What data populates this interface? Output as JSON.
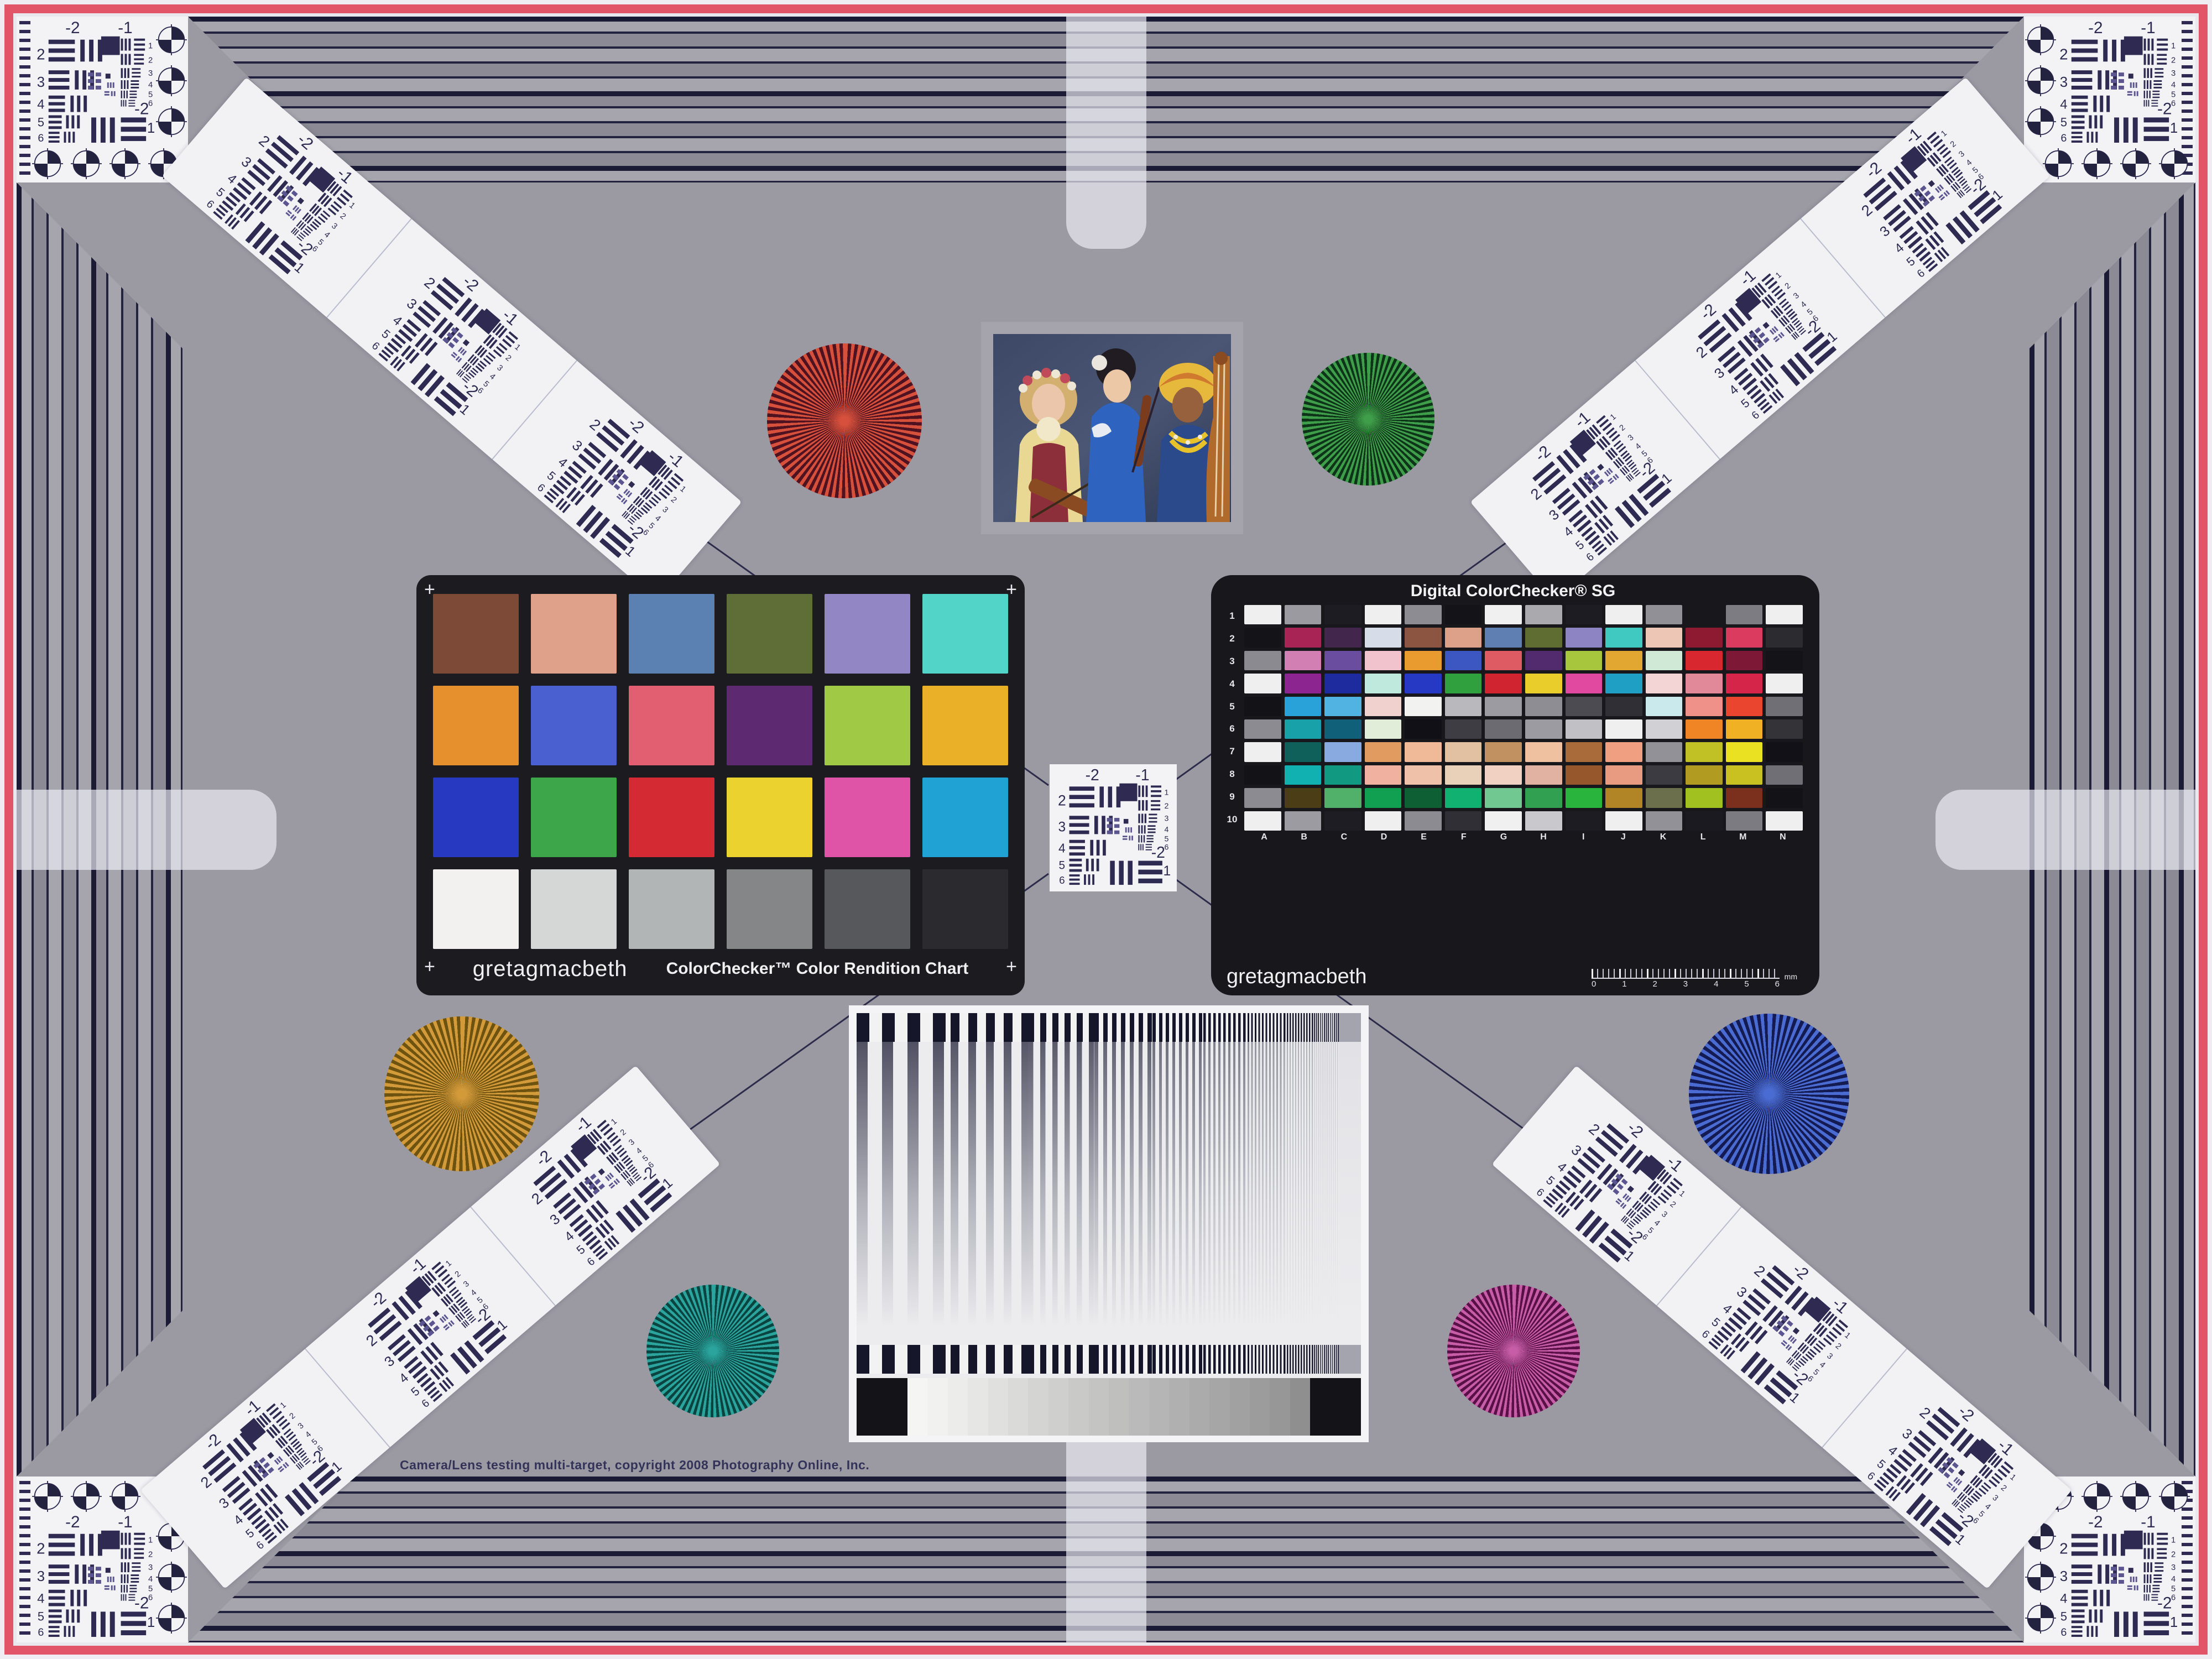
{
  "page": {
    "copyright": "Camera/Lens testing multi-target, copyright 2008 Photography Online, Inc."
  },
  "colors": {
    "background_gray": "#9b9aa3",
    "frame_pink": "#e25568",
    "line_ink": "#23233f",
    "panel_black": "#1b1b20"
  },
  "usaf": {
    "top": [
      "-2",
      "-1"
    ],
    "left": [
      "2",
      "3",
      "4",
      "5",
      "6"
    ],
    "right": [
      "1",
      "2",
      "3",
      "4",
      "5",
      "6"
    ],
    "bottom": [
      "-2",
      "1"
    ]
  },
  "colorchecker": {
    "brand": "gretagmacbeth",
    "title": "ColorChecker™ Color Rendition Chart",
    "corner_mark": "+",
    "patches": [
      "#7d4a38",
      "#dfa189",
      "#5b80b2",
      "#5e6e36",
      "#9287c4",
      "#52d5c8",
      "#e5902c",
      "#4a5fd0",
      "#e25f72",
      "#5d2a72",
      "#a0c946",
      "#eab028",
      "#2639c0",
      "#3da64b",
      "#d42a33",
      "#ecd22e",
      "#e054a8",
      "#21a2d4",
      "#f2f1ef",
      "#d5d6d6",
      "#b2b5b6",
      "#848688",
      "#57585c",
      "#2b2b2f"
    ]
  },
  "sg": {
    "title": "Digital ColorChecker® SG",
    "brand": "gretagmacbeth",
    "row_labels": [
      "1",
      "2",
      "3",
      "4",
      "5",
      "6",
      "7",
      "8",
      "9",
      "10"
    ],
    "col_labels": [
      "A",
      "B",
      "C",
      "D",
      "E",
      "F",
      "G",
      "H",
      "I",
      "J",
      "K",
      "L",
      "M",
      "N"
    ],
    "ruler_ticks": [
      "0",
      "1",
      "2",
      "3",
      "4",
      "5",
      "6"
    ],
    "ruler_unit": "mm",
    "patches": [
      [
        "#efeff0",
        "#9a9aa0",
        "#1c1c22",
        "#efeff0",
        "#8c8c92",
        "#141418",
        "#f0f0f1",
        "#aaaaae",
        "#1c1c22",
        "#efeff0",
        "#909096",
        "#17171c",
        "#7c7c82",
        "#efeff0"
      ],
      [
        "#141418",
        "#a82454",
        "#42264c",
        "#d6dde8",
        "#8c5542",
        "#dda18a",
        "#5f7eb2",
        "#5f6d32",
        "#8c84c3",
        "#40c9c1",
        "#edc6b5",
        "#8d1a31",
        "#da3b5f",
        "#2c2c30"
      ],
      [
        "#8a8a90",
        "#d280b3",
        "#6b4da0",
        "#f0c3cd",
        "#e99b30",
        "#3c57c1",
        "#de5b63",
        "#522b6f",
        "#a7c63e",
        "#e1a730",
        "#d0e9d6",
        "#d92730",
        "#7d1937",
        "#141418"
      ],
      [
        "#efeff0",
        "#8d2591",
        "#1d2b9f",
        "#c0e9dd",
        "#2539c5",
        "#309f3d",
        "#d02531",
        "#e9cd2a",
        "#e149a0",
        "#209fc5",
        "#f3d5d5",
        "#e18999",
        "#d52549",
        "#efeff0"
      ],
      [
        "#131317",
        "#29a1d9",
        "#50b3e1",
        "#f1d1cd",
        "#f2f2f1",
        "#b9b9bd",
        "#9b9ba1",
        "#8d8d93",
        "#4b4b51",
        "#2f2f35",
        "#c9e9ed",
        "#f09189",
        "#e9452f",
        "#6f6f75"
      ],
      [
        "#8b8b91",
        "#19a1a9",
        "#116079",
        "#e1edd9",
        "#101016",
        "#3d3d43",
        "#6b6b71",
        "#9b9ba1",
        "#c1c1c5",
        "#efeff0",
        "#d1d1d5",
        "#f08525",
        "#f1b125",
        "#343438"
      ],
      [
        "#efeff0",
        "#0f5f5b",
        "#89a9e1",
        "#e19b61",
        "#f0b997",
        "#e1c1a1",
        "#c19161",
        "#f0c1a1",
        "#a96b39",
        "#f09f81",
        "#919197",
        "#c1c125",
        "#e9e121",
        "#111117"
      ],
      [
        "#131317",
        "#11b1b1",
        "#119981",
        "#f0b1a1",
        "#f0c1a9",
        "#e9d1b9",
        "#f1d1c1",
        "#e1b1a1",
        "#97572d",
        "#e99b81",
        "#3b3b41",
        "#b19b21",
        "#c9c121",
        "#6f6f75"
      ],
      [
        "#8b8b91",
        "#4b3d15",
        "#51b16b",
        "#119f51",
        "#0f5f35",
        "#11b171",
        "#71c991",
        "#31a151",
        "#29b53d",
        "#b18525",
        "#6b6f4b",
        "#a1c121",
        "#7b2f1d",
        "#131317"
      ],
      [
        "#efeff0",
        "#9b9ba1",
        "#1d1d23",
        "#efeff0",
        "#8b8b91",
        "#2f2f35",
        "#f0f0f1",
        "#c9c9cd",
        "#1c1c22",
        "#efeff0",
        "#919197",
        "#1a1a20",
        "#7b7b81",
        "#efeff0"
      ]
    ]
  },
  "grayscale": {
    "steps": [
      "#f5f5f3",
      "#f1f1ef",
      "#ececea",
      "#e6e6e4",
      "#e0e0de",
      "#dadad8",
      "#d4d4d2",
      "#cfcfcd",
      "#c9c9c7",
      "#c4c4c2",
      "#bfbfbd",
      "#bababa",
      "#b5b5b5",
      "#b0b0b0",
      "#ababab",
      "#a6a6a6",
      "#a1a1a1",
      "#9c9c9c",
      "#979797",
      "#8f8f8f"
    ]
  },
  "stars": [
    {
      "name": "red-siemens-star",
      "light": "#d6503c",
      "dark": "#4e1220"
    },
    {
      "name": "green-siemens-star",
      "light": "#3f9e49",
      "dark": "#0d3318"
    },
    {
      "name": "gold-siemens-star",
      "light": "#d39a3a",
      "dark": "#6e5210"
    },
    {
      "name": "teal-siemens-star",
      "light": "#2aa49d",
      "dark": "#0a4440"
    },
    {
      "name": "blue-siemens-star",
      "light": "#4a6cd2",
      "dark": "#141a52"
    },
    {
      "name": "magenta-siemens-star",
      "light": "#c75da6",
      "dark": "#581047"
    }
  ]
}
